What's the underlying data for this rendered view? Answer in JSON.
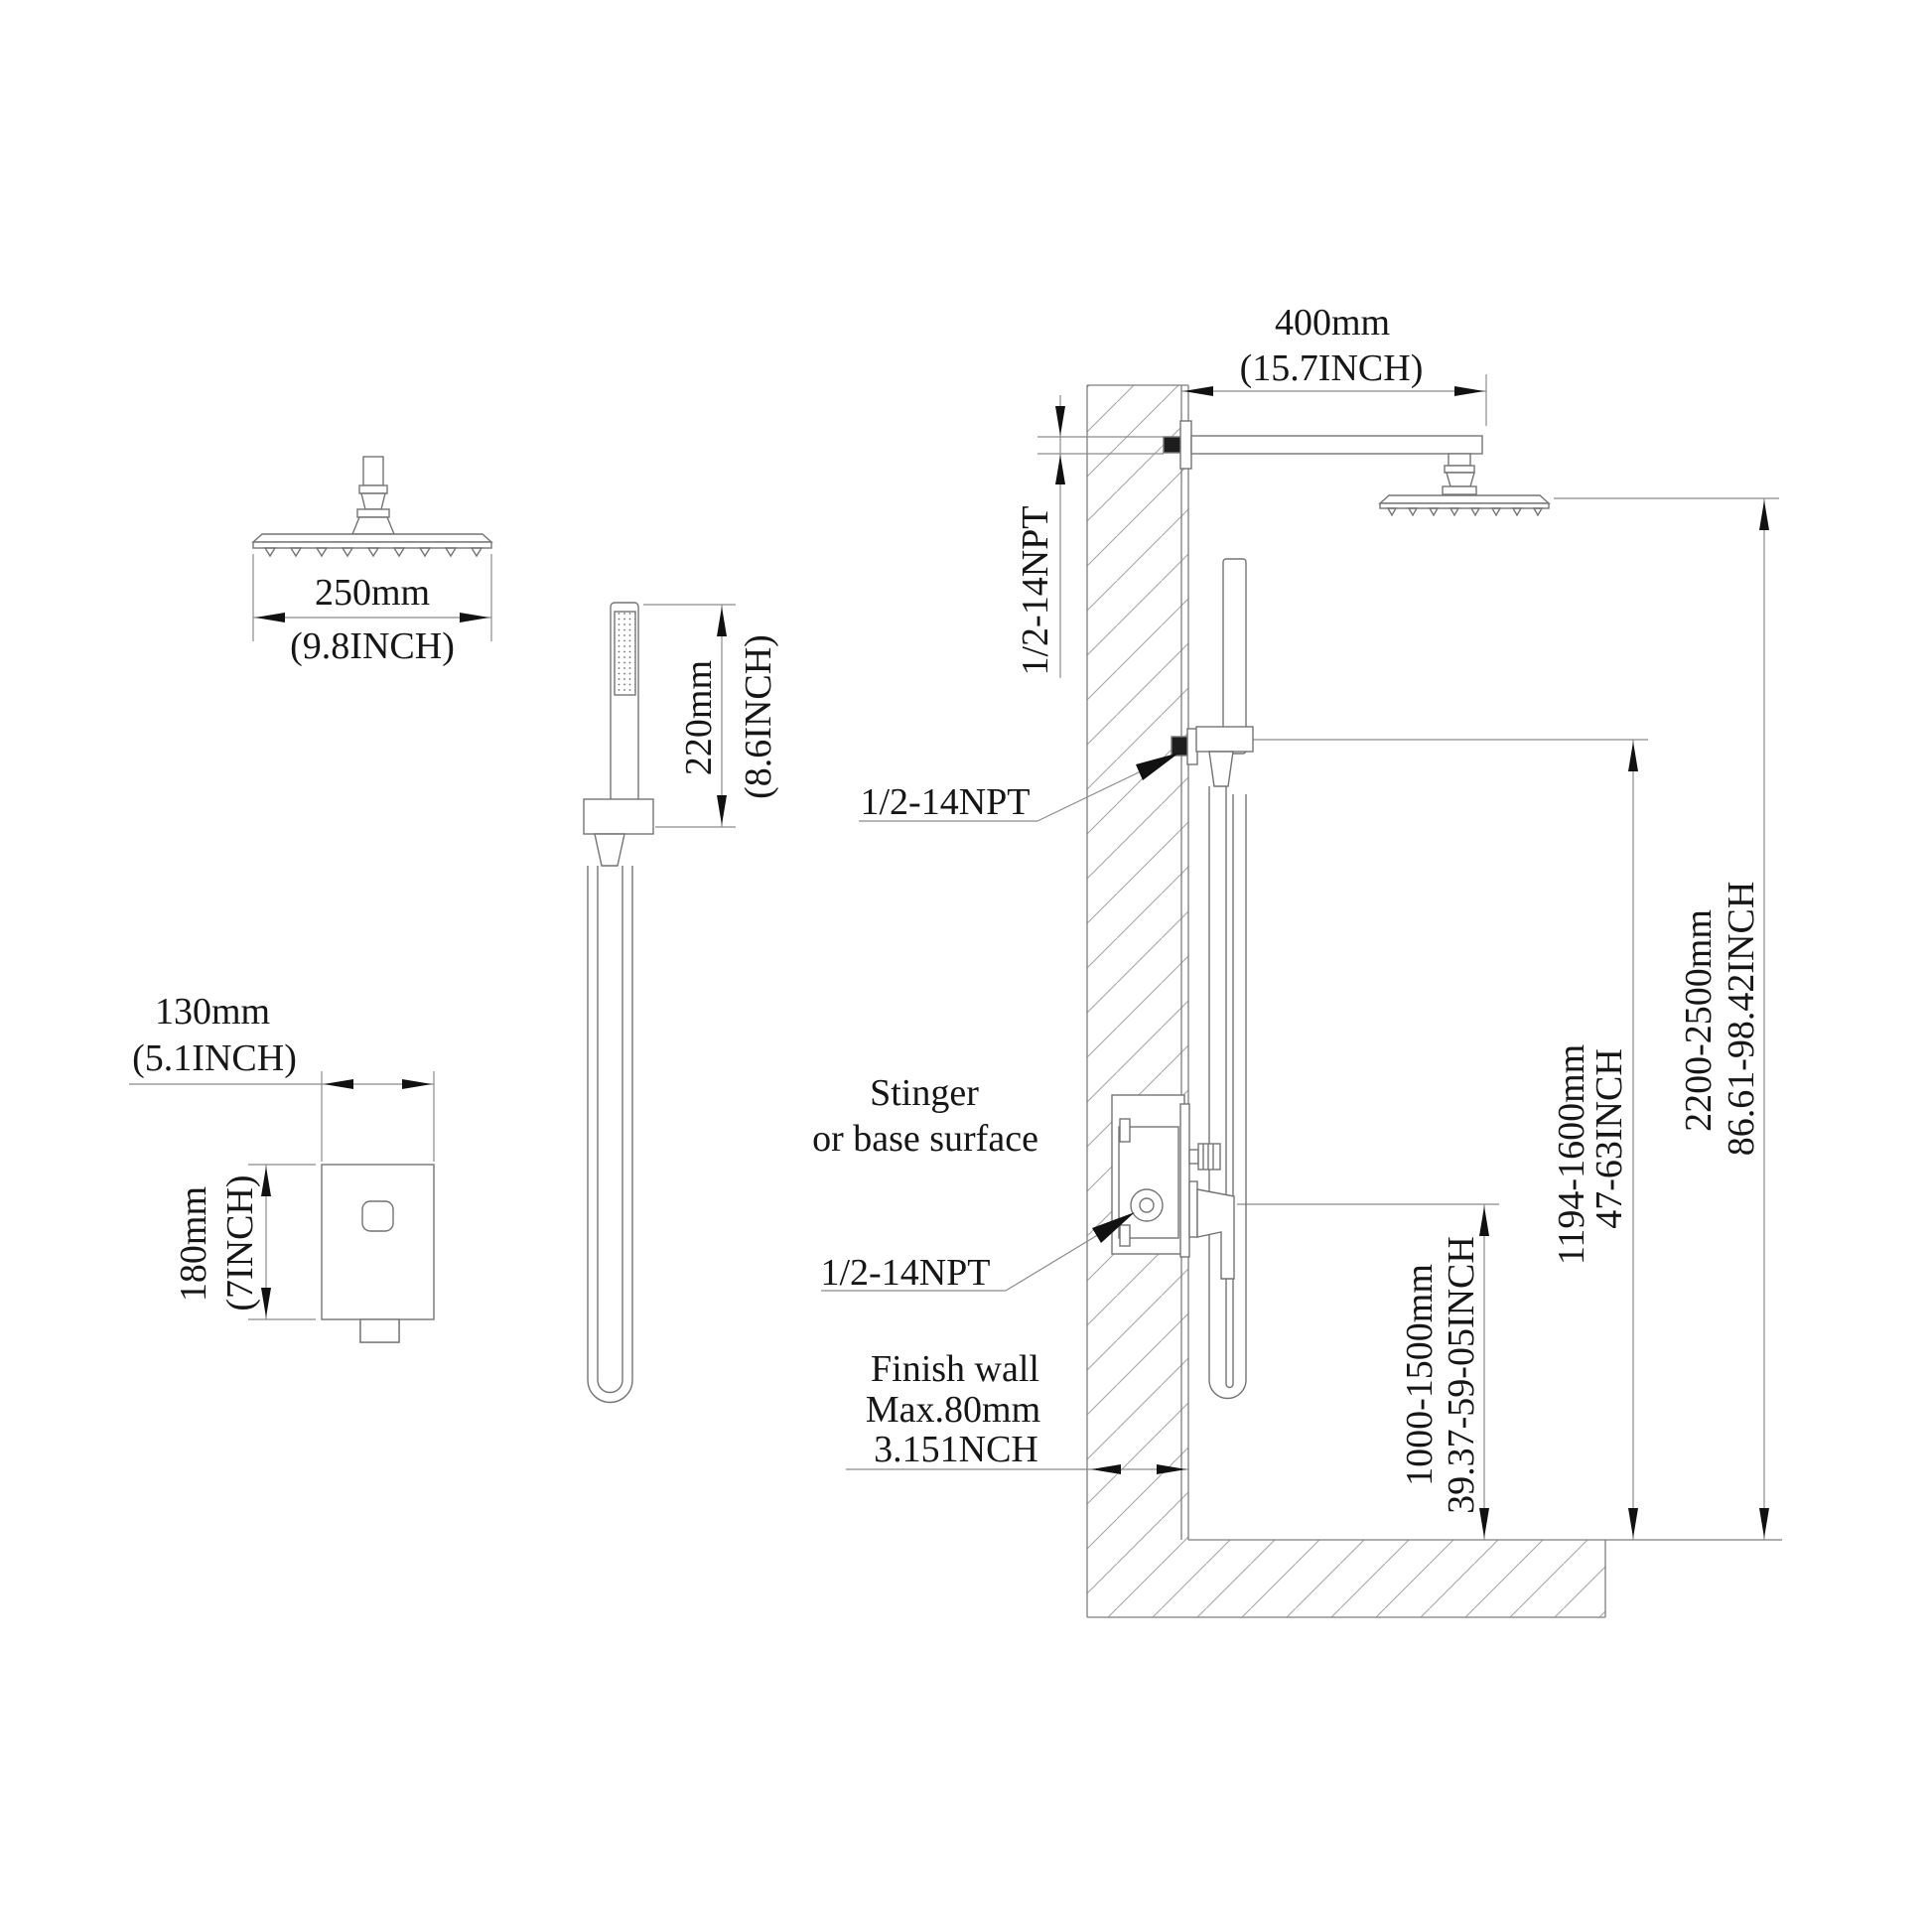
{
  "title": "Shower system installation dimension diagram",
  "colors": {
    "line": "#747474",
    "thin_line": "#8b8b8b",
    "hatch": "#a0a0a0",
    "text": "#161616",
    "arrow": "#111111"
  },
  "rain_head": {
    "width_mm": "250mm",
    "width_in": "(9.8INCH)"
  },
  "hand_shower": {
    "length_mm": "220mm",
    "length_in": "(8.6INCH)"
  },
  "valve": {
    "width_mm": "130mm",
    "width_in": "(5.1INCH)",
    "height_mm": "180mm",
    "height_in": "(7INCH)"
  },
  "side_view": {
    "arm_length_mm": "400mm",
    "arm_length_in": "(15.7INCH)",
    "arm_thread": "1/2-14NPT",
    "outlet_thread": "1/2-14NPT",
    "valve_thread": "1/2-14NPT",
    "note_line1": "Stinger",
    "note_line2": "or base surface",
    "finish_wall_1": "Finish wall",
    "finish_wall_2": "Max.80mm",
    "finish_wall_3": "3.151NCH",
    "valve_height_mm": "1000-1500mm",
    "valve_height_in": "39.37-59-05INCH",
    "outlet_height_mm": "1194-1600mm",
    "outlet_height_in": "47-63INCH",
    "head_height_mm": "2200-2500mm",
    "head_height_in": "86.61-98.42INCH"
  }
}
